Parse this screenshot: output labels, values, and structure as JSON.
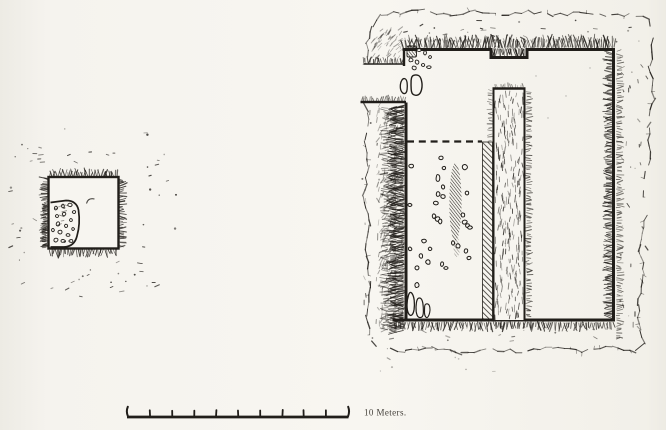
{
  "figure": {
    "kind": "excavation-plan-drawing",
    "colors": {
      "ink": "#211e1a",
      "paper": "#f7f5f0"
    }
  },
  "scale_bar": {
    "label": "10 Meters.",
    "divisions": 10
  }
}
